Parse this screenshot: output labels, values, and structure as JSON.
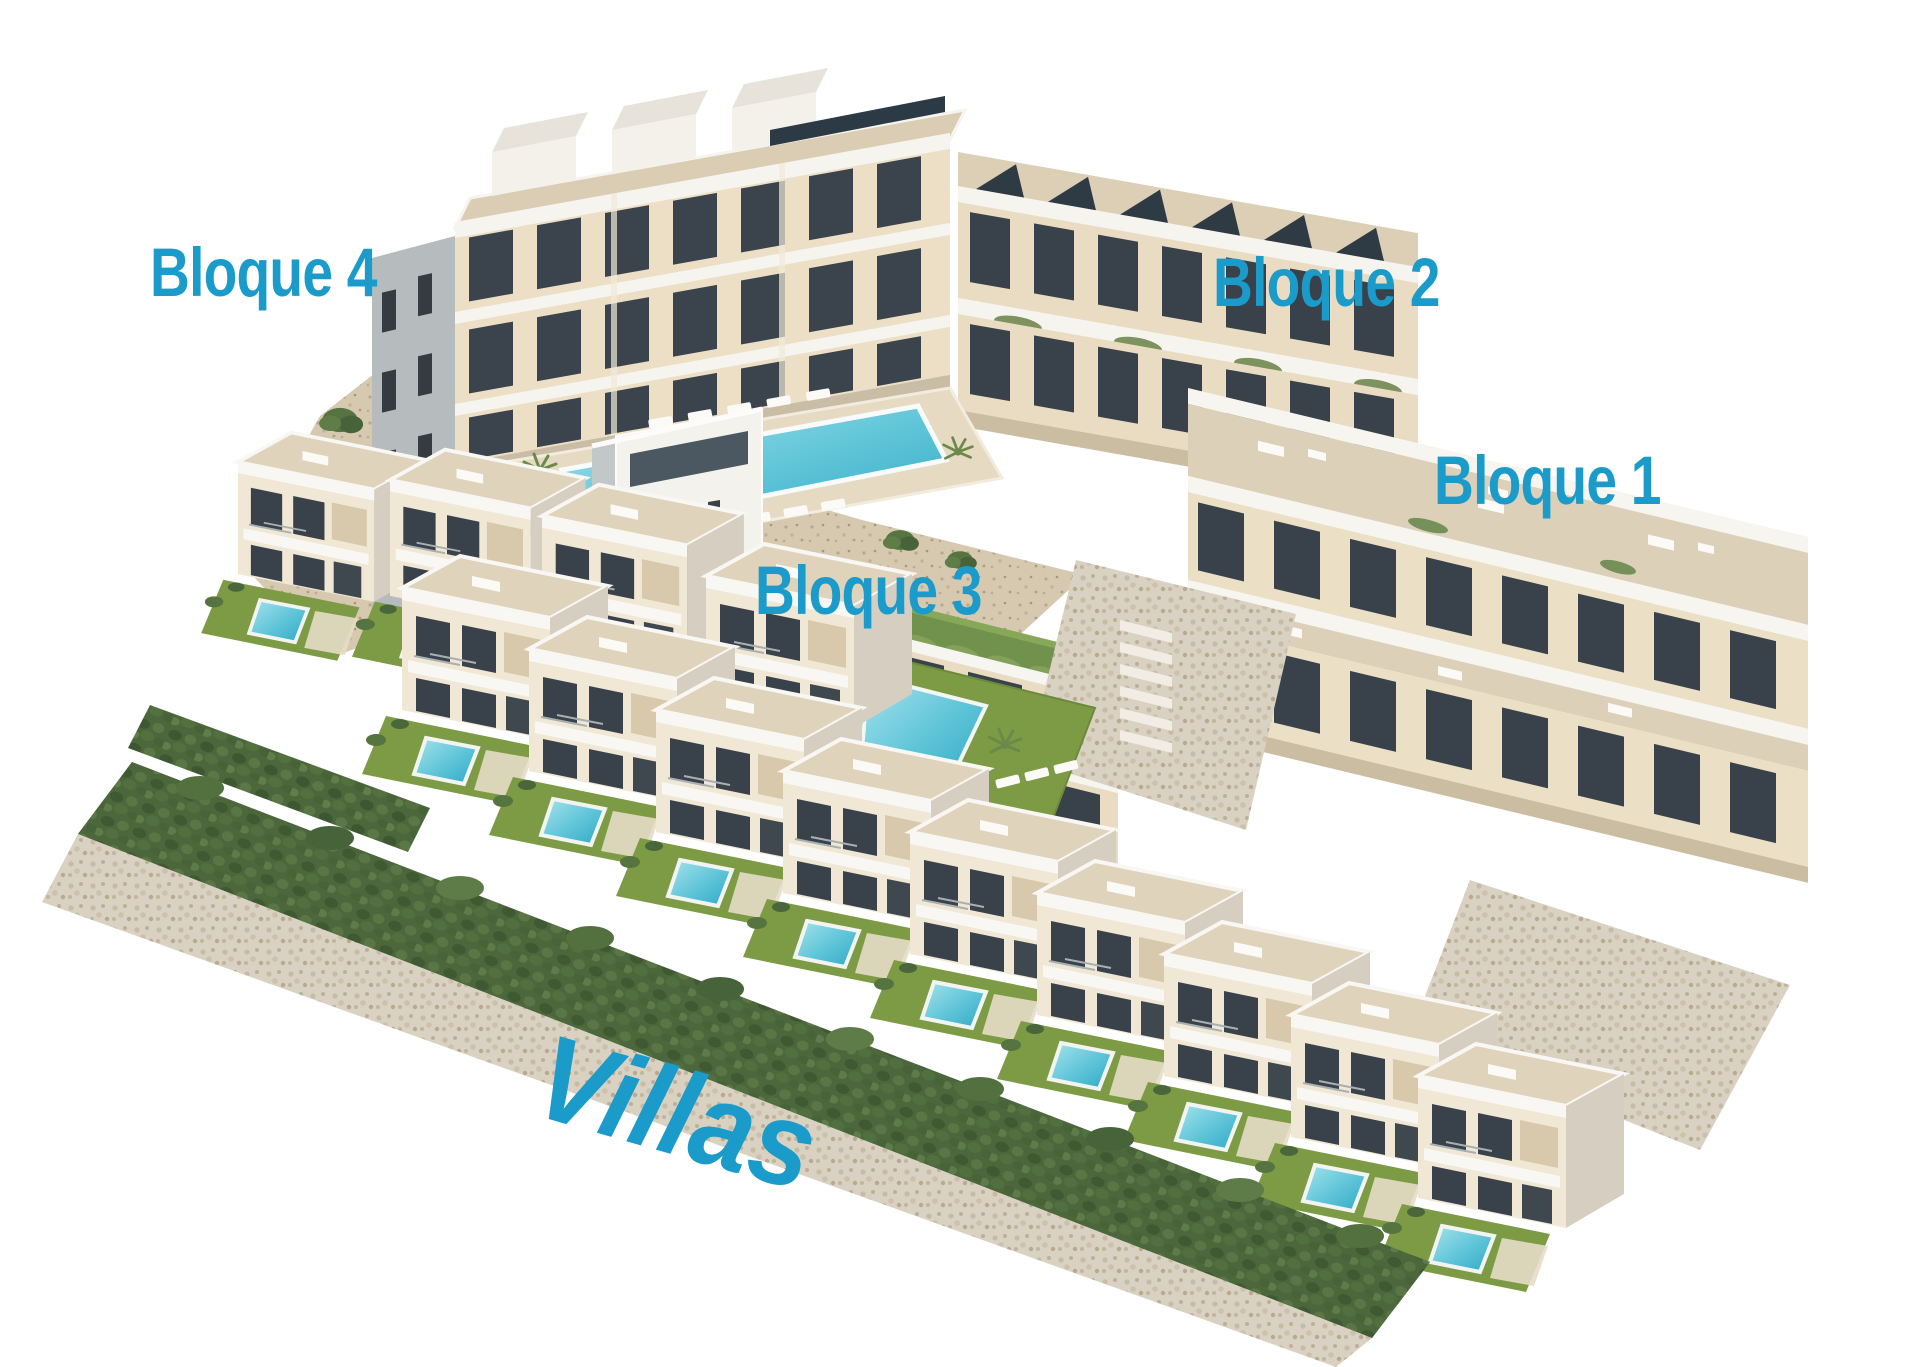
{
  "scene": {
    "description": "Aerial 3D architectural rendering of a hillside residential development with four apartment blocks, communal pools and a row of villas with private pools and gardens",
    "background_color": "#ffffff",
    "label_color": "#1b9bca",
    "labels": {
      "bloque4": "Bloque 4",
      "bloque2": "Bloque 2",
      "bloque1": "Bloque 1",
      "bloque3": "Bloque 3",
      "villas": "Villas"
    },
    "palette": {
      "building_white": "#f4f2ec",
      "facade_cream": "#e9dcc2",
      "roof_deck_beige": "#dccfb6",
      "window_glass": "#39424a",
      "pool_water": "#5ec4d8",
      "lawn_green": "#7d9b44",
      "hedge_green": "#4c673c",
      "stone_beige": "#d8cfc0"
    }
  }
}
